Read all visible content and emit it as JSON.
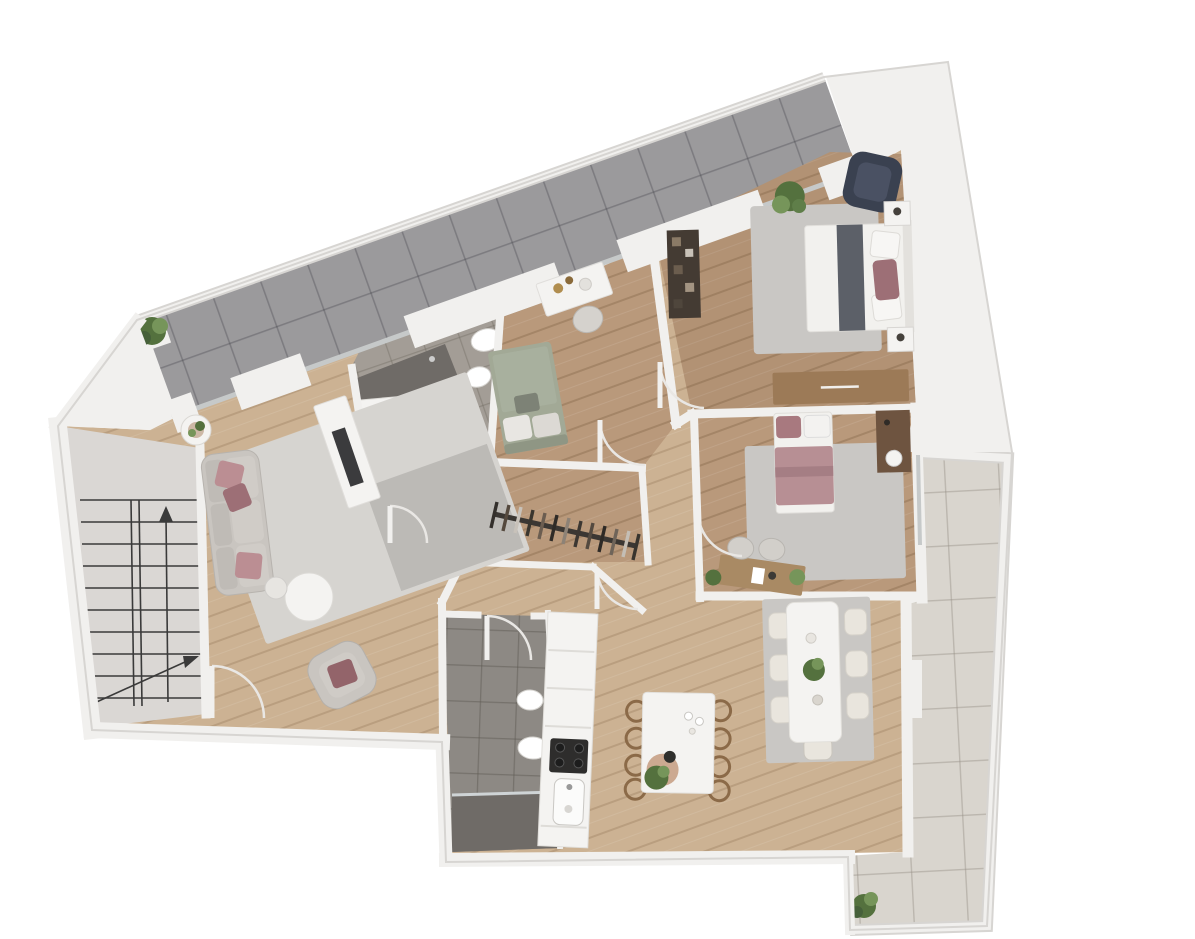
{
  "scene": {
    "type": "apartment-floor-plan-3d-top-view",
    "background": "#ffffff",
    "notes": "3D rendered top-down floor plan of an apartment; no text labels are visible in the image"
  },
  "palette": {
    "wall": "#f1f0ee",
    "wall_shadow": "#d7d5d2",
    "wood_light": "#ccb293",
    "wood_medium": "#b9997b",
    "terrace_tile": "#9b9a9c",
    "balcony_tile": "#d9d5ce",
    "bath_tile": "#a39d96",
    "bath_tile_dark": "#8d8984",
    "shower_dark": "#6f6b67",
    "stair_floor": "#dad7d4",
    "stair_line": "#3a3a3a",
    "rug_light": "#d6d4d0",
    "rug_gray": "#c9c7c4",
    "sofa_gray": "#c9c5c0",
    "pillow_pink": "#bb8e93",
    "pillow_mauve": "#9d6f76",
    "armchair_navy": "#3a4150",
    "bed_white": "#f2f1ee",
    "throw_gray": "#5c6068",
    "bed_sage": "#a2a996",
    "bed_pink": "#b78f94",
    "furniture_wood": "#9c7a57",
    "furniture_dark_wood": "#6e5440",
    "wardrobe_dark": "#443b33",
    "counter_white": "#f4f3f1",
    "cooktop_black": "#2e2d2c",
    "plant_green": "#54713e",
    "plant_green_light": "#76955a",
    "chair_brown": "#8b6a48",
    "chair_cream": "#e9e5dd",
    "door_arc": "#e9e7e4",
    "glass": "#c6c9c9"
  },
  "areas": [
    {
      "id": "terrace-upper",
      "name": "Upper terrace",
      "floor": "dark gray tile",
      "items": [
        "potted plant"
      ]
    },
    {
      "id": "stairwell",
      "name": "Stairwell",
      "floor": "light gray screed",
      "items": [
        "staircase drawing with direction arrows"
      ]
    },
    {
      "id": "living-room",
      "name": "Living room",
      "floor": "light oak",
      "items": [
        "sofa with pink cushions",
        "armchair with cushion",
        "round coffee table",
        "small side table",
        "side table with plant",
        "tv sideboard",
        "area rug"
      ]
    },
    {
      "id": "bathroom-main",
      "name": "Main bathroom",
      "floor": "gray tile",
      "items": [
        "walk-in shower",
        "double washbasin vanity",
        "toilet",
        "bidet"
      ]
    },
    {
      "id": "bedroom-center",
      "name": "Center bedroom",
      "floor": "oak",
      "items": [
        "double bed with sage bedding",
        "desk with decor",
        "desk chair"
      ]
    },
    {
      "id": "walk-in-closet",
      "name": "Walk-in closet",
      "floor": "oak",
      "items": [
        "clothes rail with hanging clothes"
      ]
    },
    {
      "id": "hallway",
      "name": "Hallway",
      "floor": "light oak",
      "items": [
        "four door swings"
      ]
    },
    {
      "id": "master-bedroom",
      "name": "Master bedroom",
      "floor": "oak",
      "items": [
        "double bed with gray throw and mauve pillow",
        "navy armchair",
        "potted plant",
        "area rug",
        "two nightstands",
        "wooden dresser",
        "dark open shelf"
      ]
    },
    {
      "id": "bedroom-2",
      "name": "Second bedroom",
      "floor": "oak",
      "items": [
        "single bed with pink bedding",
        "tall nightstand with lamp",
        "desk with two chairs",
        "two small plants",
        "area rug"
      ]
    },
    {
      "id": "kitchen",
      "name": "Kitchen",
      "floor": "light oak",
      "items": [
        "counter run with cooktop and sink",
        "island table",
        "brown bentwood chairs",
        "plant",
        "serving board and glasses"
      ]
    },
    {
      "id": "dining-area",
      "name": "Dining area",
      "floor": "light oak",
      "items": [
        "white dining table",
        "seven cream chairs",
        "plant centerpiece",
        "area rug"
      ]
    },
    {
      "id": "bathroom-2",
      "name": "Second bathroom",
      "floor": "dark gray tile",
      "items": [
        "shower",
        "toilet",
        "bidet"
      ]
    },
    {
      "id": "balcony-right",
      "name": "Right balcony",
      "floor": "light beige tile",
      "items": [
        "potted plant"
      ]
    }
  ]
}
